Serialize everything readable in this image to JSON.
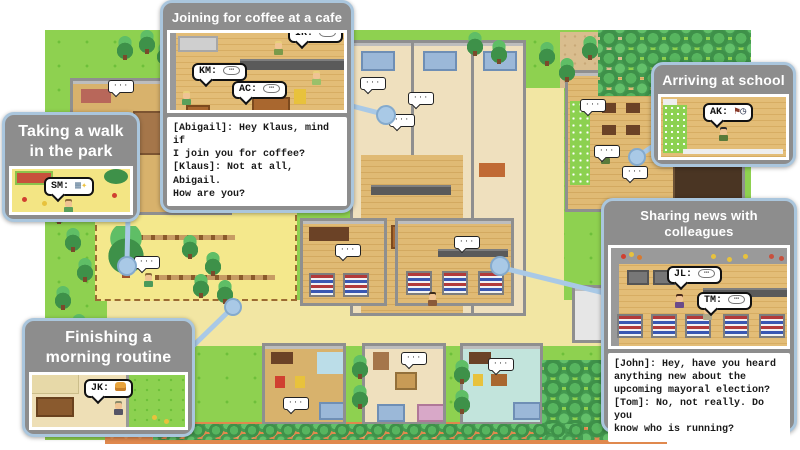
{
  "colors": {
    "panel_border": "#aac6dd",
    "panel_bg": "#8d8d8d",
    "leader_line": "#a9c9e6",
    "grass": "#8ed150",
    "path_sand": "#f2e6a3",
    "path_orange": "#e0894e",
    "dialogue_bg": "#ffffff"
  },
  "map": {
    "mini_bubble_glyph": "···"
  },
  "panels": {
    "coffee": {
      "title": "Joining for coffee at a cafe",
      "bubbles": [
        {
          "label": "KM:",
          "glyph": "⋯"
        },
        {
          "label": "AC:",
          "glyph": "⋯"
        },
        {
          "label": "IR:",
          "glyph": "⋯"
        }
      ],
      "dialogue": "[Abigail]: Hey Klaus, mind if\nI join you for coffee?\n[Klaus]: Not at all, Abigail.\nHow are you?"
    },
    "walk": {
      "title_line1": "Taking a walk",
      "title_line2": "in the park",
      "bubble": {
        "label": "SM:",
        "glyph": "▦",
        "glyph2": "✦"
      }
    },
    "school": {
      "title": "Arriving at school",
      "bubble": {
        "label": "AK:",
        "glyph": "⚑",
        "glyph2": "◷"
      }
    },
    "news": {
      "title": "Sharing news with colleagues",
      "bubbles": [
        {
          "label": "JL:",
          "glyph": "⋯"
        },
        {
          "label": "TM:",
          "glyph": "⋯"
        }
      ],
      "dialogue": "[John]: Hey, have you heard\nanything new about the\nupcoming mayoral election?\n[Tom]: No, not really. Do you\nknow who is running?"
    },
    "routine": {
      "title_line1": "Finishing a",
      "title_line2": "morning routine",
      "bubble": {
        "label": "JK:"
      }
    }
  }
}
